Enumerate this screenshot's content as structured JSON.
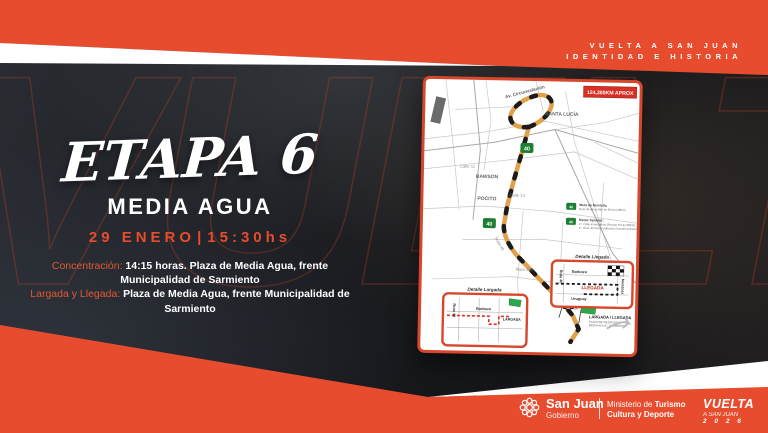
{
  "colors": {
    "accent": "#E84C2E",
    "route": "#E3A04B",
    "badge_red": "#D93025",
    "shield_green": "#1E7E34"
  },
  "watermark": "VUELTA",
  "header": {
    "line1": "VUELTA A SAN JUAN",
    "line2": "IDENTIDAD E HISTORIA"
  },
  "stage": {
    "title": "ETAPA 6",
    "location": "MEDIA AGUA",
    "date": "29 ENERO",
    "sep": "|",
    "time": "15:30hs",
    "concentracion_label": "Concentración:",
    "concentracion_text": " 14:15 horas. Plaza de Media Agua, frente Municipalidad de Sarmiento",
    "largada_label": "Largada y Llegada:",
    "largada_text": " Plaza de Media Agua, frente Municipalidad de Sarmiento"
  },
  "map": {
    "distance_badge": "124,300KM APROX",
    "shield": "40",
    "labels": {
      "av_circunvalacion": "Av. Circunvalación",
      "santa_lucia": "SANTA LUCÍA",
      "rawson": "RAWSON",
      "pocito": "POCITO",
      "calle_11": "Calle 11",
      "calle_14": "Calle 14",
      "ruta_40": "Ruta 40",
      "ruta_295": "Ruta 295",
      "sarmiento": "SARMIENTO"
    },
    "legend": {
      "item1_title": "Meta de Montaña",
      "item1_line": "Ruta 40 altura Alto de Sierra (39Km)",
      "item2_title": "Metas Sprinter:",
      "item2_line1": "1°- Calle Intermedios (Parque Pocito 58Km)",
      "item2_line2": "2°- Ruta 40 frente Vallecitos Grandes (Chanway Punta 114Km)"
    },
    "detalle_largada": {
      "title": "Detalle Largada",
      "street": "Barboza",
      "ruta": "Ruta 40",
      "marker": "LARGADA"
    },
    "detalle_llegada": {
      "title": "Detalle Llegada",
      "street": "Barboza",
      "street2": "Uruguay",
      "street3": "Mendoza",
      "ruta": "Ruta 40",
      "marker": "LLEGADA"
    },
    "start_finish": {
      "title": "LARGADA / LLEGADA",
      "line1": "PLAZA DE MEDIA AGUA",
      "line2": "MEDIA AGUA - SARMIENTO"
    }
  },
  "footer": {
    "gov_name": "San Juan",
    "gov_sub": "Gobierno",
    "ministry_light": "Ministerio de ",
    "ministry_bold": "Turismo",
    "ministry_line2": "Cultura y Deporte",
    "event_name": "VUELTA",
    "event_sub": "A SAN JUAN",
    "event_year": "2 0 2 6"
  }
}
